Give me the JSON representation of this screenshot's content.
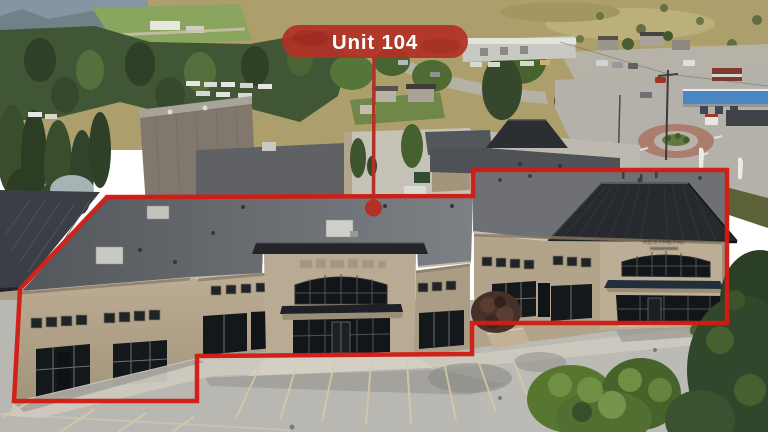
{
  "annotation": {
    "unit_label": "Unit 104",
    "outline_color": "#cf1d15",
    "callout_color": "#b23025",
    "label_text_color": "#ffffff"
  },
  "building": {
    "tenant_sign_text": "AESTHETIC",
    "tenant_sign_color": "#2e2a24"
  },
  "palette": {
    "hill_grass": "#ac9f6c",
    "forest_green": "#415634",
    "wall_tan": "#b2a38b",
    "wall_tan_light": "#bcae95",
    "roof_flat_right": "#6e7075",
    "roof_hip_dark": "#26292e",
    "glass_dark": "#14171c",
    "asphalt": "#b9b7b1",
    "walkway_concrete": "#ccc8be",
    "stall_line": "#d6c9a6",
    "gas_canopy_blue": "#4a86c2",
    "tree_bright": "#57762f",
    "pine_dark": "#31462a"
  }
}
